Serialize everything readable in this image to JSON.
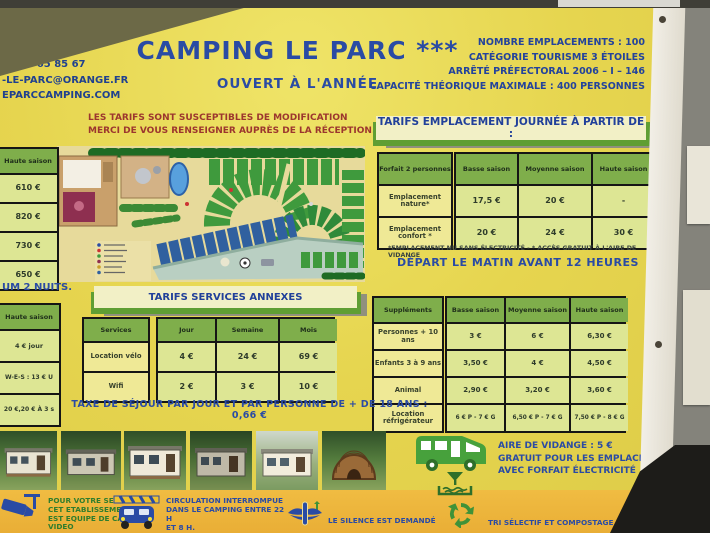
{
  "header": {
    "contact_lines": [
      "TE DE MAUGUIO",
      "970 LATTES",
      "04 67 65 85 67",
      "-LE-PARC@ORANGE.FR",
      "EPARCCAMPING.COM"
    ],
    "title": "CAMPING LE PARC ***",
    "subtitle": "OUVERT À L'ANNÉE",
    "info_lines": [
      "NOMBRE EMPLACEMENTS : 100",
      "CATÉGORIE TOURISME 3 ÉTOILES",
      "ARRÊTÉ PRÉFECTORAL 2006 – I – 146",
      "CAPACITÉ THÉORIQUE MAXIMALE : 400 PERSONNES"
    ]
  },
  "notice": {
    "line1": "LES TARIFS SONT SUSCEPTIBLES DE MODIFICATION",
    "line2": "MERCI DE VOUS RENSEIGNER AUPRÈS DE LA RÉCEPTION."
  },
  "left_rates": {
    "header": "Haute saison",
    "rows": [
      "610 €",
      "820 €",
      "730 €",
      "650 €"
    ],
    "note": "UM 2 NUITS."
  },
  "left_week": {
    "header": "Haute saison",
    "rows": [
      "4 € jour",
      "W-E-S : 13 € U",
      "20 €,20 € À 3 s"
    ]
  },
  "emplacement": {
    "title": "TARIFS EMPLACEMENT JOURNÉE À PARTIR DE :",
    "corner": "Forfait 2 personnes",
    "cols": [
      "Basse saison",
      "Moyenne saison",
      "Haute saison"
    ],
    "rows": [
      {
        "label": "Emplacement nature*",
        "v": [
          "17,5 €",
          "20 €",
          "-"
        ]
      },
      {
        "label": "Emplacement confort *",
        "v": [
          "20 €",
          "24 €",
          "30 €"
        ]
      }
    ],
    "footnote": "*EMPLACEMENT NU SANS ÉLECTRICITÉ - * ACCÈS GRATUIT À L'AIRE DE VIDANGE",
    "depart": "DÉPART LE MATIN AVANT 12 HEURES"
  },
  "supplements": {
    "corner": "Suppléments",
    "cols": [
      "Basse saison",
      "Moyenne saison",
      "Haute saison"
    ],
    "rows": [
      {
        "label": "Personnes + 10 ans",
        "v": [
          "3 €",
          "6 €",
          "6,30 €"
        ]
      },
      {
        "label": "Enfants 3 à 9 ans",
        "v": [
          "3,50 €",
          "4 €",
          "4,50 €"
        ]
      },
      {
        "label": "Animal",
        "v": [
          "2,90 €",
          "3,20 €",
          "3,60 €"
        ]
      },
      {
        "label": "Location réfrigérateur",
        "v": [
          "6 € P - 7 € G",
          "6,50 € P - 7 € G",
          "7,50 € P - 8 € G"
        ]
      }
    ]
  },
  "services": {
    "title": "TARIFS SERVICES ANNEXES",
    "corner": "Services",
    "cols": [
      "Jour",
      "Semaine",
      "Mois"
    ],
    "rows": [
      {
        "label": "Location vélo",
        "v": [
          "4 €",
          "24 €",
          "69 €"
        ]
      },
      {
        "label": "Wifi",
        "v": [
          "2 €",
          "3 €",
          "10 €"
        ]
      }
    ]
  },
  "tax": "TAXE DE SÉJOUR PAR JOUR ET PAR PERSONNE DE + DE 18 ANS : 0,66 €",
  "vidange": {
    "line1": "AIRE DE VIDANGE : 5 €",
    "line2": "GRATUIT POUR LES EMPLACEMENTS",
    "line3": "AVEC FORFAIT ÉLECTRICITÉ"
  },
  "footer": {
    "security": [
      "POUR VOTRE SECURITE",
      "CET ETABLISSEMENT",
      "EST EQUIPE DE CAMERA",
      "VIDEO"
    ],
    "circulation": [
      "CIRCULATION INTERROMPUE",
      "DANS LE CAMPING ENTRE 22 H",
      "ET 8 H.",
      "22 H - 7 H SUR JUILLET ET"
    ],
    "silence": "LE SILENCE EST DEMANDÉ",
    "tri": "TRI SÉLECTIF ET COMPOSTAGE"
  },
  "colors": {
    "sign_yellow": "#e6d54f",
    "footer_strip": "#efb93f",
    "table_header_green": "#7fae4b",
    "table_cell": "#dde694",
    "label_cell": "#efe996",
    "brand_blue": "#2a4ba4",
    "notice_red": "#9c362e",
    "titlebar_cream": "#f2f0c6",
    "titlebar_green": "#5f9e33"
  }
}
